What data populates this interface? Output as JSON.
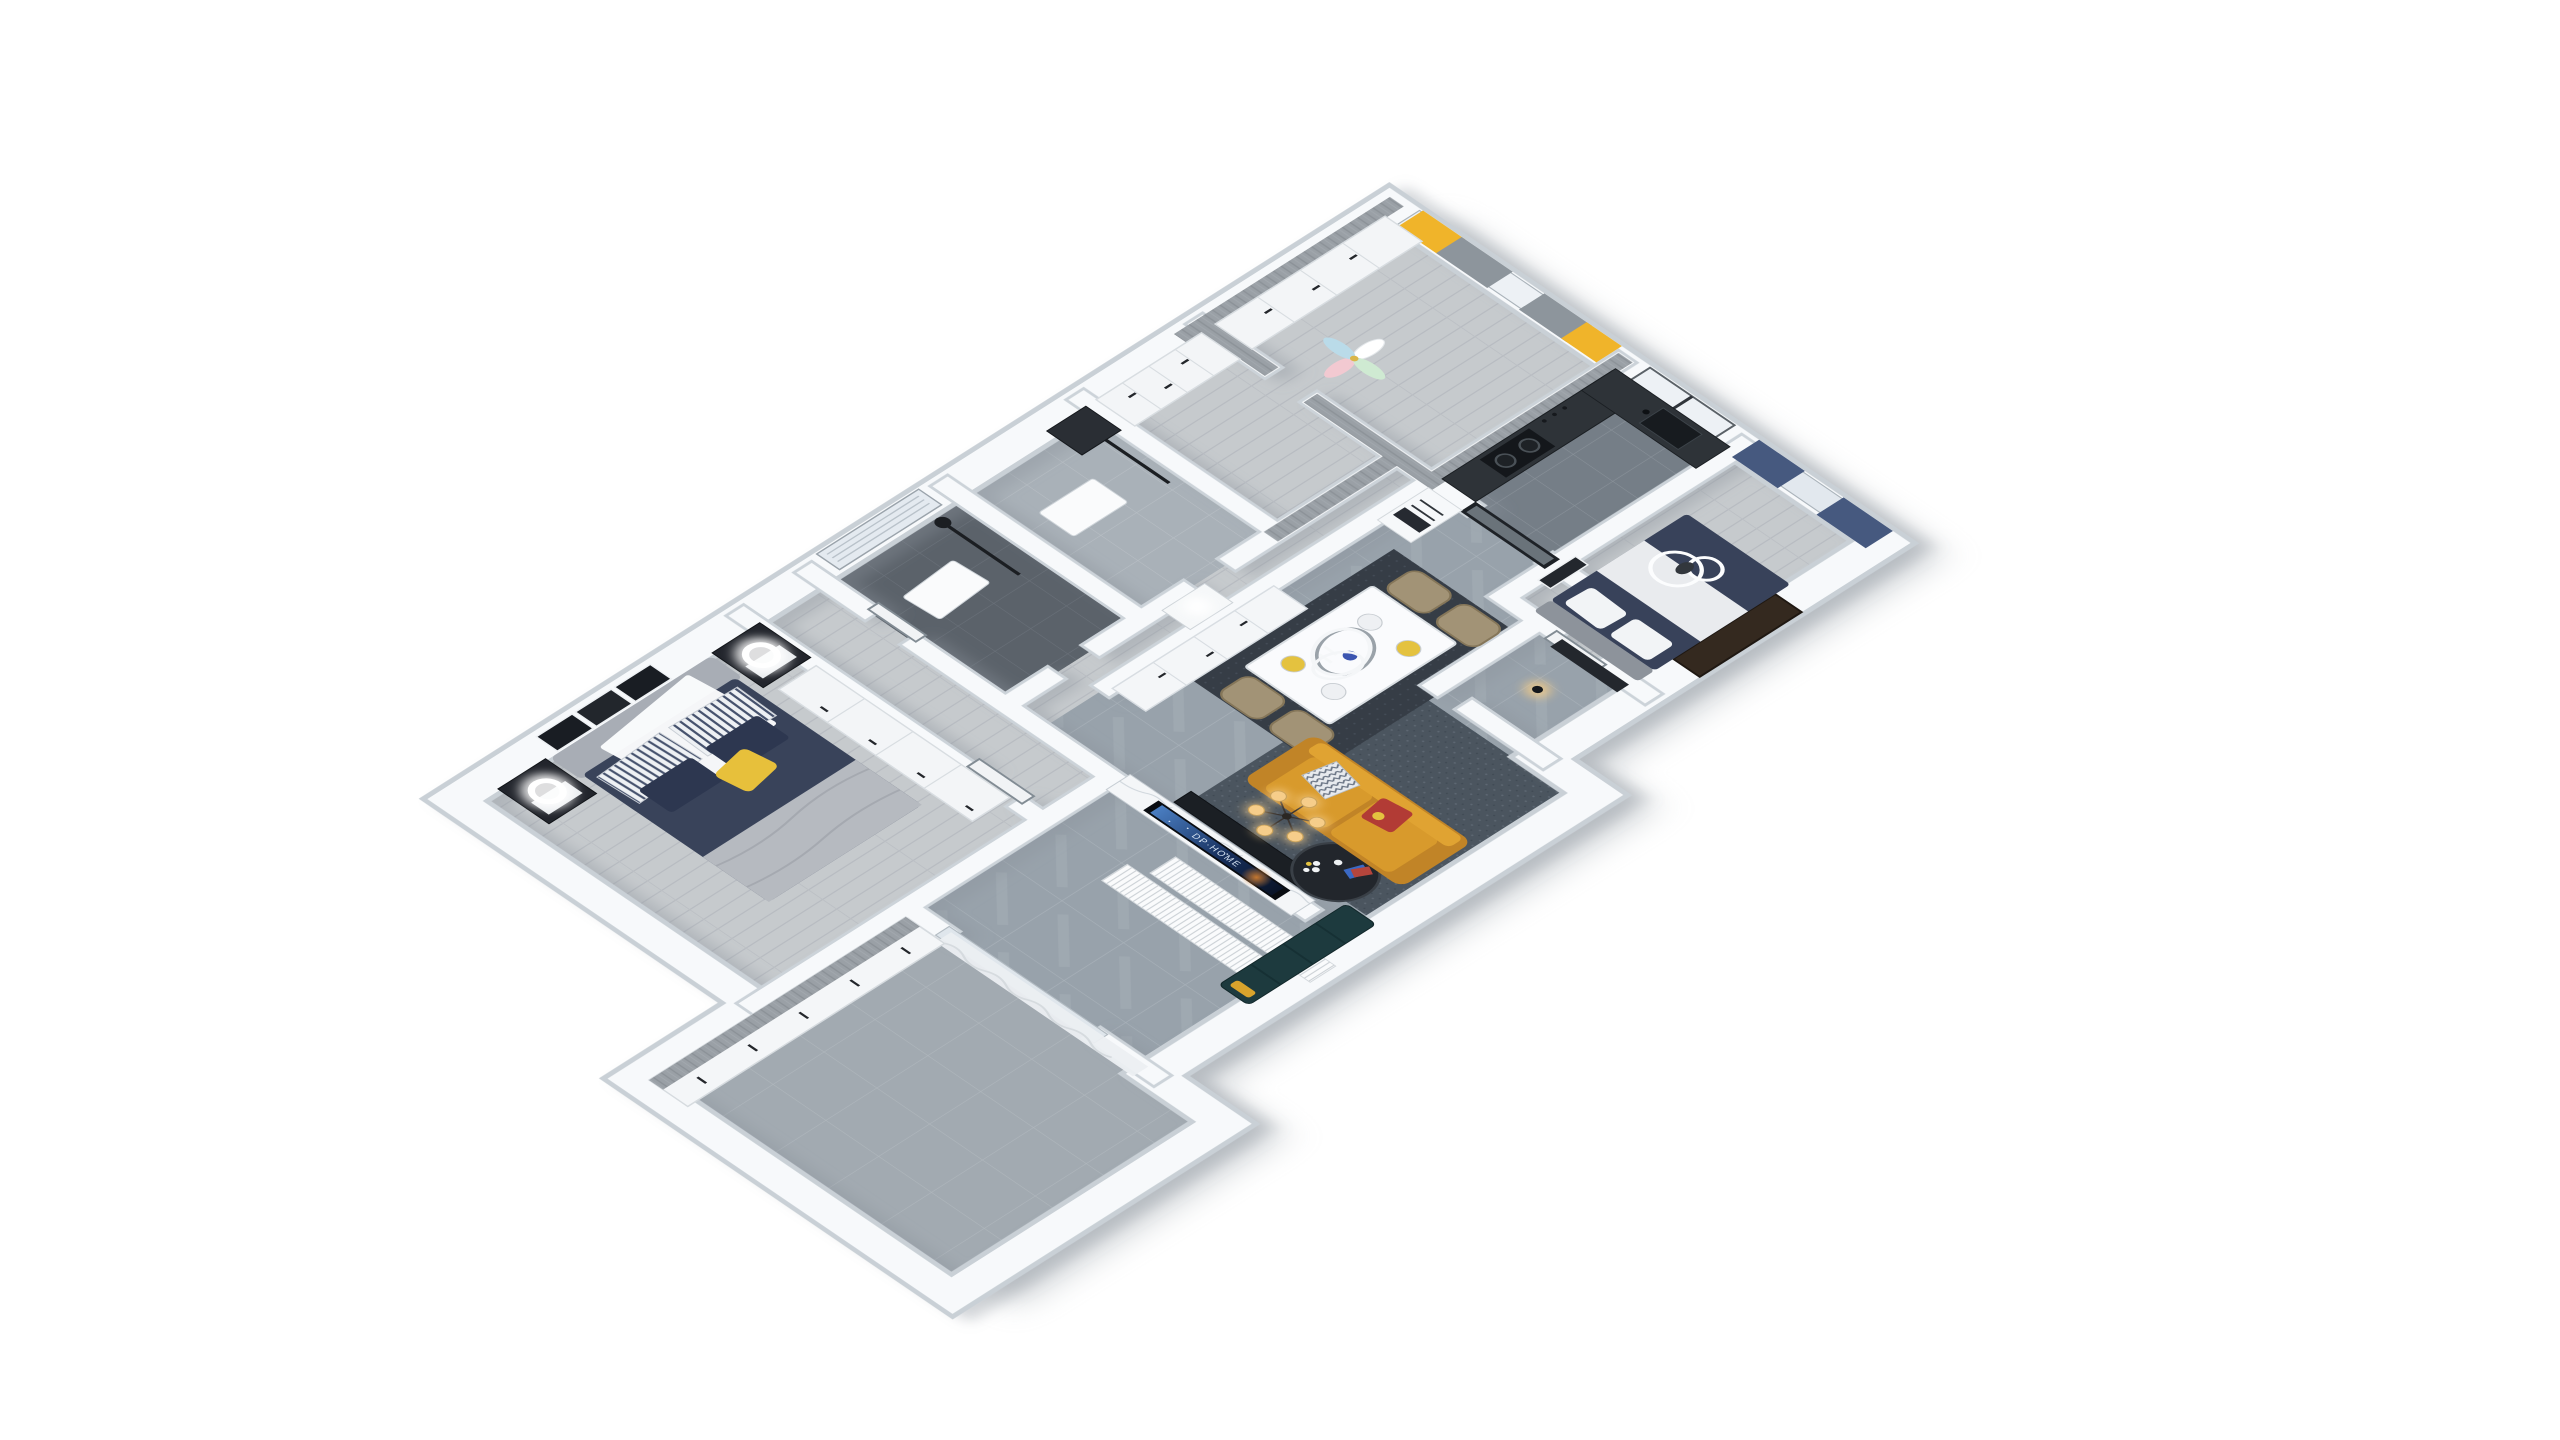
{
  "scene": {
    "kind": "3d-floorplan-dollhouse-render",
    "view": "isometric top-down cutaway of an apartment",
    "background_color": "#ffffff"
  },
  "tv": {
    "screen_text": "DP·HOME",
    "screen_image": "galaxy-night-sky-with-orange-horizon"
  },
  "palette": {
    "wall_top": "#f7f9fb",
    "wall_edge": "#c9d0d6",
    "wood_floor": "#c6cacd",
    "gray_tile_floor": "#98a2ab",
    "dark_bath_tile": "#5b626a",
    "light_bath_tile": "#a9b1b8",
    "kitchen_tile": "#757e87",
    "sofa_mustard": "#d89a2c",
    "accent_yellow_curtain": "#f0b42a",
    "navy_curtain": "#46597f",
    "navy_bedding": "#38425a",
    "living_rug": "#4b555f",
    "dining_rug": "#363d46",
    "counter_dark": "#2e3338",
    "teal_bench": "#1d3a3e",
    "warm_light": "#f7cf8d"
  },
  "rooms": [
    {
      "name": "master-bedroom",
      "floor": "gray-wood",
      "items": [
        "double-bed",
        "navy-duvet",
        "gray-throw-blanket",
        "striped-pillows",
        "yellow-throw-pillow",
        "two-nightstands",
        "glowing-ring-lamps",
        "triptych-wall-art",
        "white-wardrobe"
      ]
    },
    {
      "name": "balcony",
      "floor": "gray-tile",
      "items": [
        "white-storage-cabinets",
        "wood-counter-top",
        "sheer-white-curtain"
      ]
    },
    {
      "name": "bathroom-dark-tile",
      "floor": "dark-gray-tile",
      "items": [
        "window-with-blinds",
        "wall-shelf",
        "black-shower-set",
        "white-door"
      ]
    },
    {
      "name": "bathroom-light-tile",
      "floor": "light-gray-tile",
      "items": [
        "wall-shelf",
        "black-shower-set",
        "dark-vanity"
      ]
    },
    {
      "name": "hallway",
      "floor": "gray-wood",
      "items": [
        "console-desk",
        "table-lamp",
        "white-storage-cabinets"
      ]
    },
    {
      "name": "kids-bedroom",
      "floor": "gray-wood",
      "items": [
        "yellow-and-gray-curtains",
        "window",
        "pinwheel-decoration",
        "white-wardrobe",
        "gray-wood-wall-caps"
      ]
    },
    {
      "name": "kitchen",
      "floor": "gray-tile",
      "items": [
        "l-shaped-dark-countertop",
        "gas-hob",
        "sink",
        "window",
        "black-framed-sliding-glass-door",
        "refrigerator"
      ]
    },
    {
      "name": "bedroom-blue",
      "floor": "gray-wood",
      "items": [
        "navy-curtains",
        "sheer-curtain",
        "navy-double-bed",
        "double-ring-ceiling-light",
        "white-door-gray-trim",
        "wall-art"
      ]
    },
    {
      "name": "dining-area",
      "floor": "gray-marble-tile",
      "items": [
        "white-dining-table",
        "four-upholstered-chairs",
        "yellow-and-white-place-settings",
        "blue-flower-centerpiece",
        "candles",
        "dark-rug",
        "white-ring-pendant-light",
        "white-sideboard"
      ]
    },
    {
      "name": "living-room",
      "floor": "gray-marble-tile",
      "items": [
        "marble-tv-feature-wall",
        "wall-mounted-tv",
        "black-media-console",
        "mustard-yellow-sofa",
        "chevron-pillow",
        "red-accent-pillow",
        "blue-gray-rug",
        "round-glass-coffee-table",
        "white-flowers",
        "warm-bulb-chandelier",
        "teal-bench",
        "white-slatted-panels",
        "branch-floor-decal"
      ]
    },
    {
      "name": "entry-hall",
      "floor": "gray-marble-tile",
      "items": [
        "dark-entry-door",
        "pendant-bulb-light",
        "dark-shoe-cabinet"
      ]
    }
  ]
}
